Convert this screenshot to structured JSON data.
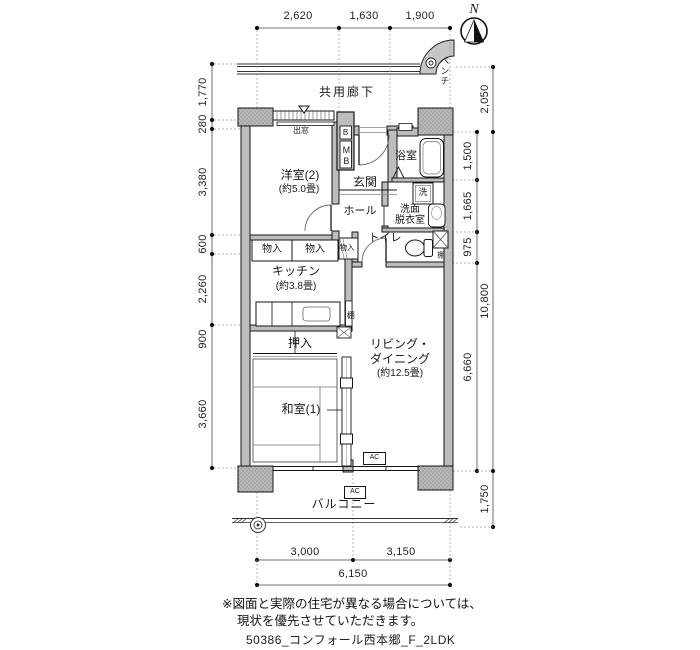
{
  "compass": {
    "label": "N"
  },
  "corridor": {
    "label": "共用廊下",
    "bench": "ベンチ"
  },
  "rooms": {
    "western2": {
      "name": "洋室(2)",
      "size": "(約5.0畳)"
    },
    "entrance": {
      "name": "玄関"
    },
    "hall": {
      "name": "ホール"
    },
    "bath": {
      "name": "浴室"
    },
    "washer": {
      "label": "洗"
    },
    "washroom": {
      "line1": "洗面",
      "line2": "脱衣室"
    },
    "toilet": {
      "name": "トイレ"
    },
    "kitchen": {
      "name": "キッチン",
      "size": "(約3.8畳)"
    },
    "storage1": {
      "name": "物入"
    },
    "storage2": {
      "name": "物入"
    },
    "storage3": {
      "name": "物入"
    },
    "closet": {
      "name": "押入"
    },
    "japanese1": {
      "name": "和室(1)"
    },
    "living": {
      "name1": "リビング・",
      "name2": "ダイニング",
      "size": "(約12.5畳)"
    },
    "balcony": {
      "name": "バルコニー"
    }
  },
  "features": {
    "bay_window": "出窓",
    "meter_box_b": "B",
    "meter_box": "MB",
    "shelf_toilet": "棚",
    "shelf_kitchen": "棚",
    "ac1": "AC",
    "ac2": "AC"
  },
  "dimensions": {
    "top": [
      "2,620",
      "1,630",
      "1,900"
    ],
    "left": [
      "1,770",
      "280",
      "3,380",
      "600",
      "2,260",
      "900",
      "3,660"
    ],
    "right_inner": [
      "1,500",
      "1,665",
      "975",
      "6,660"
    ],
    "right_outer": [
      "2,050",
      "10,800",
      "1,750"
    ],
    "bottom": [
      "3,000",
      "3,150"
    ],
    "bottom_total": "6,150"
  },
  "notes": {
    "line1": "※図面と実際の住宅が異なる場合については、",
    "line2": "現状を優先させていただきます。"
  },
  "footer": "50386_コンフォール西本郷_F_2LDK"
}
